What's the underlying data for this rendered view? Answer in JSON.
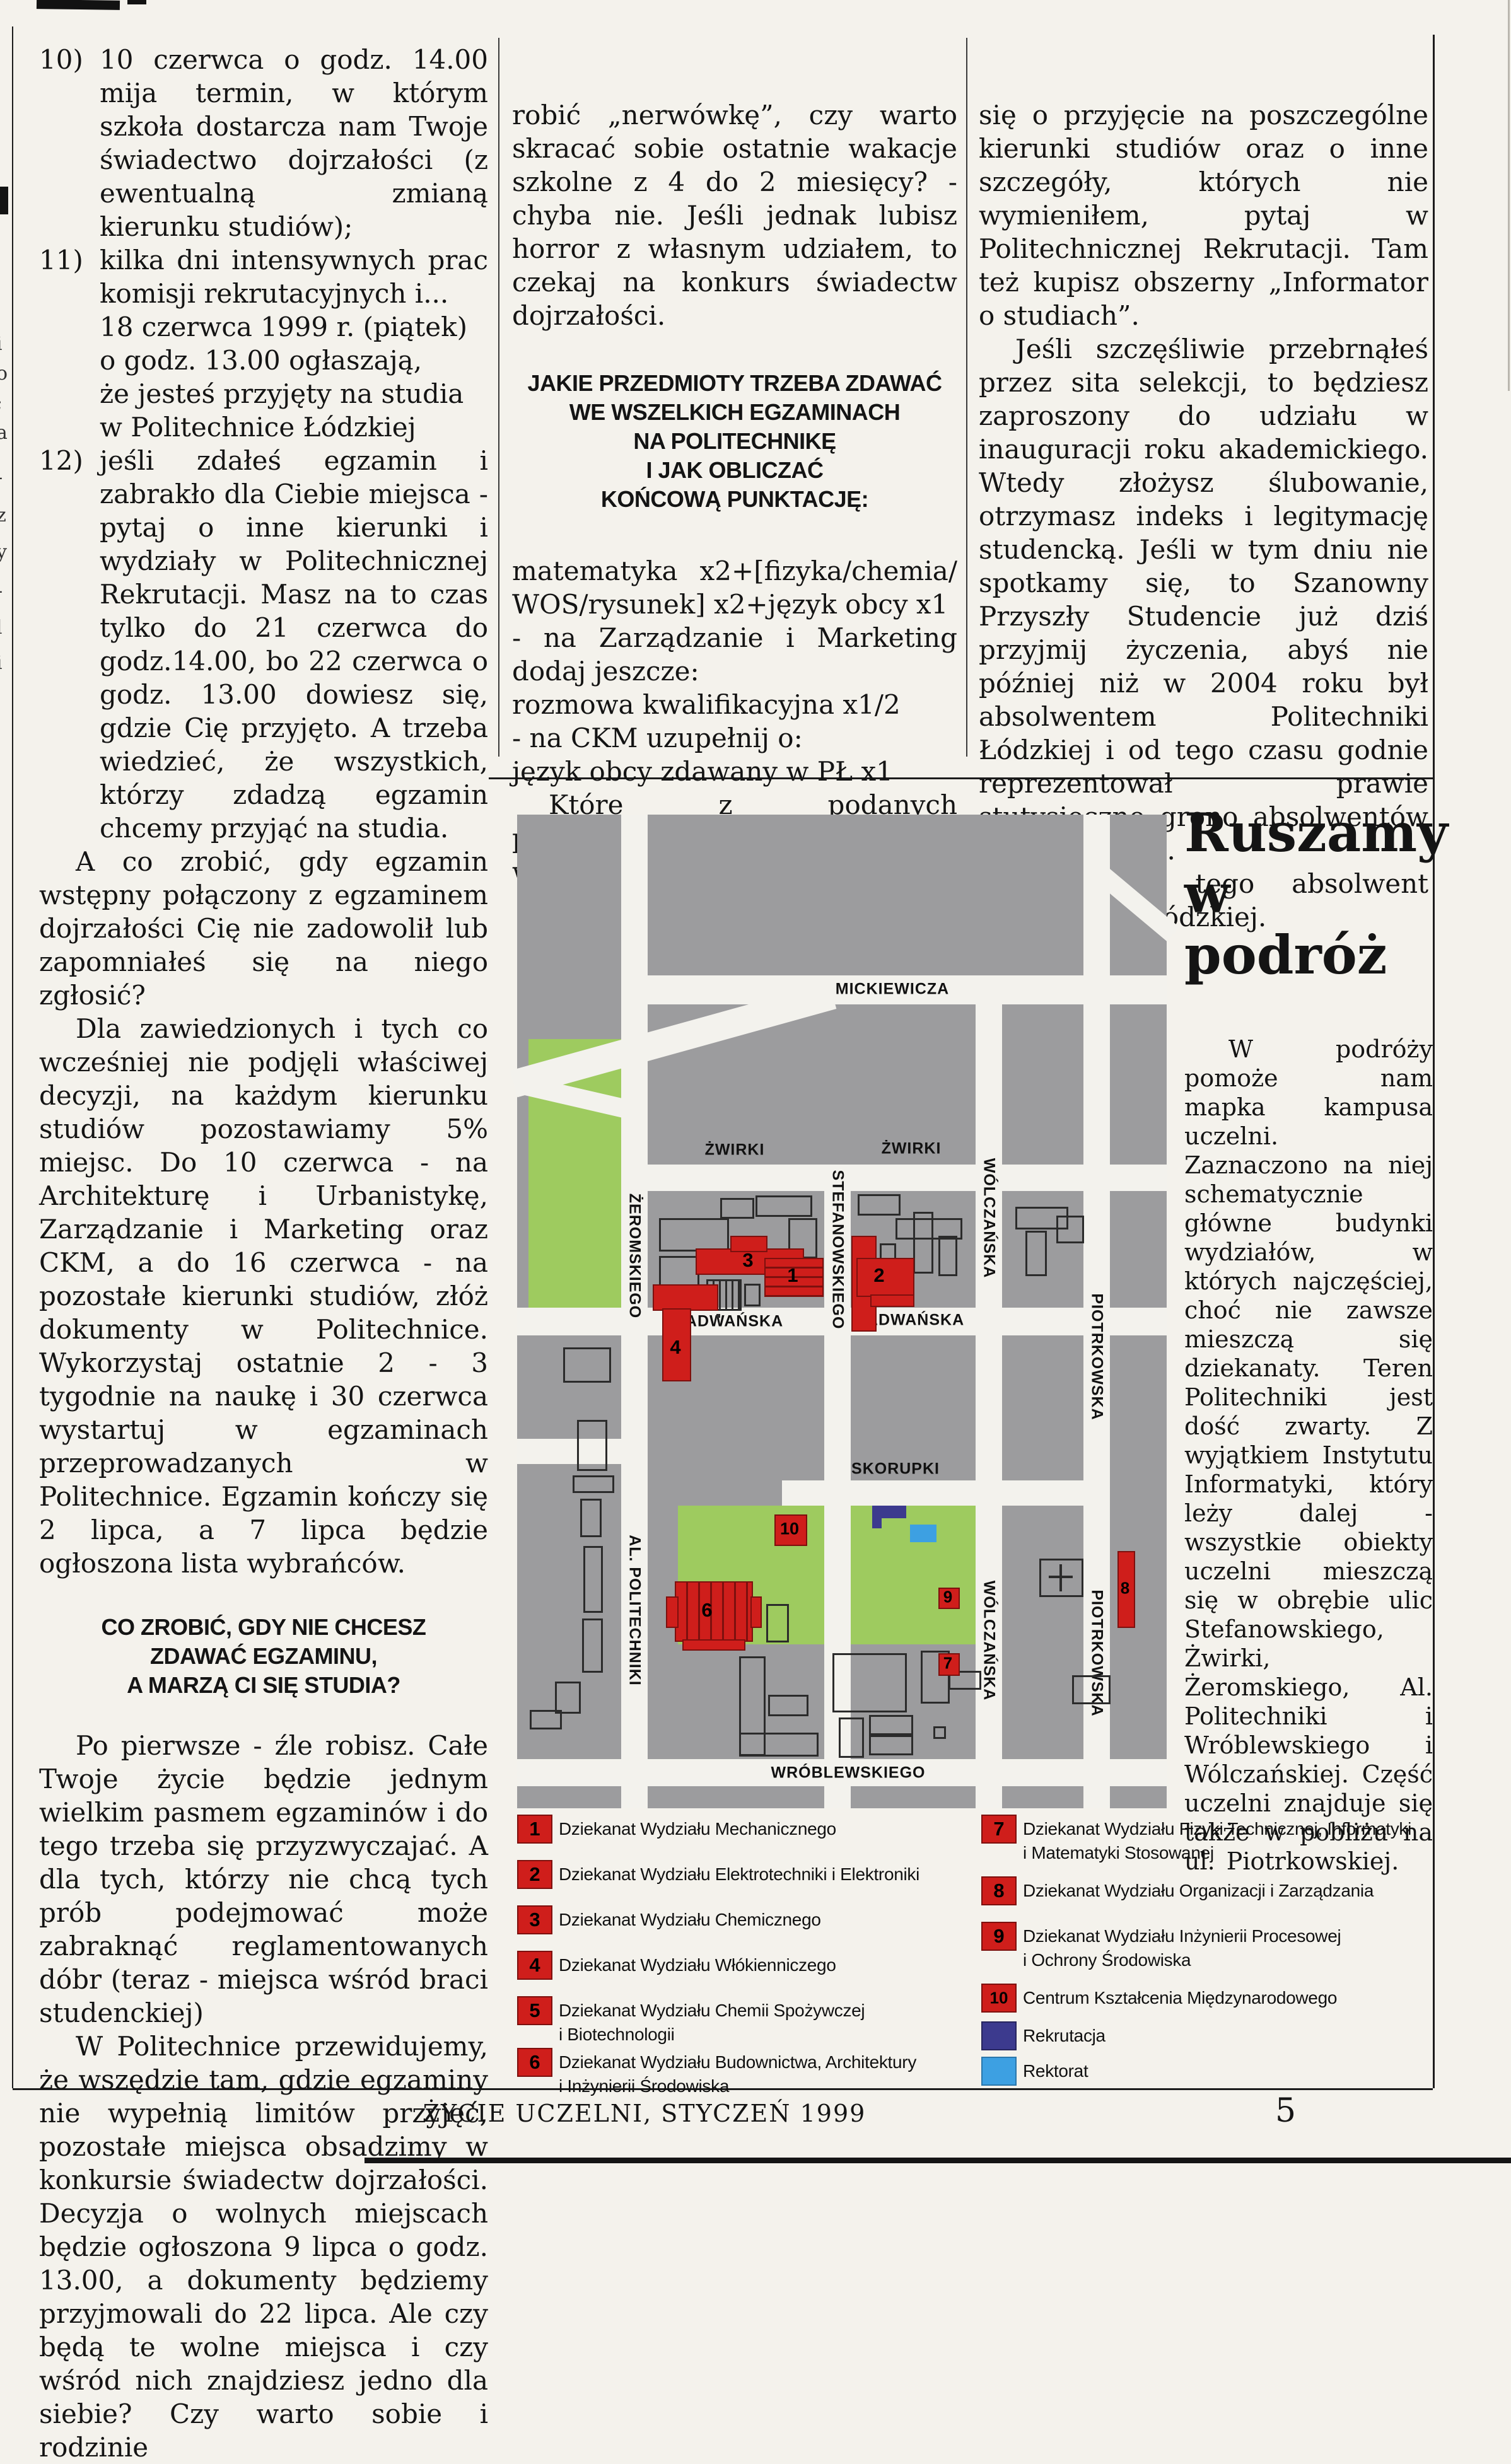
{
  "columns": {
    "col1": {
      "list": [
        {
          "num": "10)",
          "text": "10 czerwca o godz. 14.00 mija termin, w którym szkoła dostarcza nam Twoje świadectwo dojrzałości (z ewentualną zmianą kierunku studiów);"
        },
        {
          "num": "11)",
          "text": "kilka dni intensywnych prac komisji rekrutacyjnych i...",
          "lines": [
            "18 czerwca 1999 r. (piątek)",
            "o godz. 13.00 ogłaszają,",
            "że jesteś przyjęty na studia",
            "w Politechnice Łódzkiej"
          ]
        },
        {
          "num": "12)",
          "text": "jeśli zdałeś egzamin i zabrakło dla Ciebie miejsca - pytaj o inne kierunki i wydziały w Politechnicznej Rekrutacji. Masz na to czas tylko do 21 czerwca do godz.14.00, bo 22 czerwca o godz. 13.00 dowiesz się, gdzie Cię przyjęto. A trzeba wiedzieć, że wszystkich, którzy zdadzą egzamin chcemy przyjąć na studia."
        }
      ],
      "para1": "A co zrobić, gdy egzamin wstępny połączony z egzaminem dojrzałości Cię nie zadowolił lub zapomniałeś się na niego zgłosić?",
      "para2": "Dla zawiedzionych i tych co wcześniej nie podjęli właściwej decyzji, na każdym kierunku studiów pozostawiamy 5% miejsc. Do 10 czerwca - na Architekturę i Urbanistykę, Zarządzanie i Marketing oraz CKM, a do 16 czerwca - na pozostałe kierunki studiów, złóż dokumenty w Politechnice. Wykorzystaj ostatnie 2 - 3 tygodnie na naukę i 30 czerwca wystartuj w egzaminach przeprowadzanych w Politechnice. Egzamin kończy się 2 lipca, a 7 lipca będzie ogłoszona lista wybrańców.",
      "heading": "CO ZROBIĆ, GDY NIE CHCESZ\nZDAWAĆ EGZAMINU,\nA MARZĄ CI SIĘ STUDIA?",
      "para3": "Po pierwsze - źle robisz. Całe Twoje życie będzie jednym wielkim pasmem egzaminów i do tego trzeba się przyzwyczajać. A dla tych, którzy nie chcą tych prób podejmować może zabraknąć reglamentowanych dóbr (teraz - miejsca wśród braci studenckiej)",
      "para4": "W Politechnice przewidujemy, że wszędzie tam, gdzie egzaminy nie wypełnią limitów przyjęć, pozostałe miejsca obsadzimy w konkursie świadectw dojrzałości. Decyzja o wolnych miejscach będzie ogłoszona 9 lipca o godz. 13.00, a dokumenty będziemy przyjmowali do 22 lipca. Ale czy będą te wolne miejsca i czy wśród nich znajdziesz jedno dla siebie? Czy warto sobie i rodzinie"
    },
    "col2": {
      "para1": "robić „nerwówkę”, czy warto skracać sobie ostatnie wakacje szkolne z 4 do 2 miesięcy? - chyba nie. Jeśli jednak lubisz horror z własnym udziałem, to czekaj na konkurs świadectw dojrzałości.",
      "heading": "JAKIE PRZEDMIOTY TRZEBA ZDAWAĆ\nWE WSZELKICH EGZAMINACH\nNA POLITECHNIKĘ\nI JAK OBLICZAĆ\nKOŃCOWĄ PUNKTACJĘ:",
      "formula1": "matematyka x2+[fizyka/chemia/ WOS/rysunek] x2+język obcy x1",
      "formula2": "- na Zarządzanie i Marketing dodaj jeszcze:",
      "formula3": "rozmowa kwalifikacyjna x1/2",
      "formula4": "- na CKM uzupełnij o:",
      "formula5": "język obcy zdawany w PŁ x1",
      "para2": "Które z podanych przedmiotów trzeba lub można wybrać starając"
    },
    "col3": {
      "para1": "się o przyjęcie na poszczególne kierunki studiów oraz o inne szczegóły, których nie wymieniłem, pytaj w Politechnicznej Rekrutacji. Tam też kupisz obszerny „Informator o studiach”.",
      "para2": "Jeśli szczęśliwie przebrnąłeś przez sita selekcji, to będziesz zaproszony do udziału w inauguracji roku akademickiego. Wtedy złożysz ślubowanie, otrzymasz indeks i legitymację studencką. Jeśli w tym dniu nie spotkamy się, to Szanowny Przyszły Studencie już dziś przyjmij życzenia, abyś nie później niż w 2004 roku był absolwentem Politechniki Łódzkiej i od tego czasu godnie reprezentował prawie stutysięczne grono absolwentów naszej uczelni.",
      "para3": "Życzy Ci tego absolwent Politechniki Łódzkiej."
    }
  },
  "feature": {
    "headline": "Ruszamy\nw podróż",
    "body": "W podróży pomoże nam mapka kampusa uczelni. Zaznaczono na niej schematycznie główne budynki wydziałów, w których najczęściej, choć nie zawsze mieszczą się dziekanaty. Teren Politechniki jest dość zwarty. Z wyjątkiem Instytutu Informatyki, który leży dalej - wszystkie obiekty uczelni mieszczą się w obrębie ulic Stefanowskiego, Żwirki, Żeromskiego, Al. Politechniki i Wróblewskiego i Wólczańskiej. Część uczelni znajduje się także w pobliżu na ul. Piotrkowskiej."
  },
  "map": {
    "street_names": {
      "mickiewicza": "MICKIEWICZA",
      "zwirki": "ŻWIRKI",
      "zeromskiego": "ŻEROMSKIEGO",
      "stefanowskiego": "STEFANOWSKIEGO",
      "wolczanska": "WÓLCZAŃSKA",
      "piotrkowska": "PIOTRKOWSKA",
      "radwanska": "RADWAŃSKA",
      "al_politechniki": "AL. POLITECHNIKI",
      "skorupki": "SKORUPKI",
      "wroblewskiego": "WRÓBLEWSKIEGO"
    },
    "building_numbers": {
      "b1": "1",
      "b2": "2",
      "b3": "3",
      "b4": "4",
      "b5": "5",
      "b6": "6",
      "b7": "7",
      "b8": "8",
      "b9": "9",
      "b10": "10"
    },
    "colors": {
      "building_red": "#cf1e1b",
      "recruitment_navy": "#3c3a8e",
      "rectorate_blue": "#3da0e2",
      "park_green": "#9ecb5f",
      "map_gray": "#9c9c9e",
      "street_white": "#f3f2ed"
    },
    "legend_left": [
      {
        "num": "1",
        "label": "Dziekanat Wydziału Mechanicznego"
      },
      {
        "num": "2",
        "label": "Dziekanat Wydziału Elektrotechniki i Elektroniki"
      },
      {
        "num": "3",
        "label": "Dziekanat Wydziału Chemicznego"
      },
      {
        "num": "4",
        "label": "Dziekanat Wydziału Włókienniczego"
      },
      {
        "num": "5",
        "label": "Dziekanat Wydziału Chemii Spożywczej\ni Biotechnologii"
      },
      {
        "num": "6",
        "label": "Dziekanat Wydziału Budownictwa, Architektury\ni Inżynierii Środowiska"
      }
    ],
    "legend_right": [
      {
        "num": "7",
        "label": "Dziekanat Wydziału Fizyki Technicznej, Informatyki\ni Matematyki Stosowanej"
      },
      {
        "num": "8",
        "label": "Dziekanat Wydziału Organizacji i Zarządzania"
      },
      {
        "num": "9",
        "label": "Dziekanat Wydziału Inżynierii Procesowej\ni Ochrony Środowiska"
      },
      {
        "num": "10",
        "label": "Centrum Kształcenia Międzynarodowego"
      }
    ],
    "legend_other": [
      {
        "label": "Rekrutacja"
      },
      {
        "label": "Rektorat"
      }
    ]
  },
  "footer": {
    "journal": "ŻYCIE UCZELNI,  STYCZEŃ 1999",
    "page_number": "5"
  },
  "artifacts": {
    "edge_glyphs": [
      "i",
      "o",
      ";",
      "a",
      "-",
      "z",
      "y",
      "-",
      "l",
      "i"
    ]
  }
}
